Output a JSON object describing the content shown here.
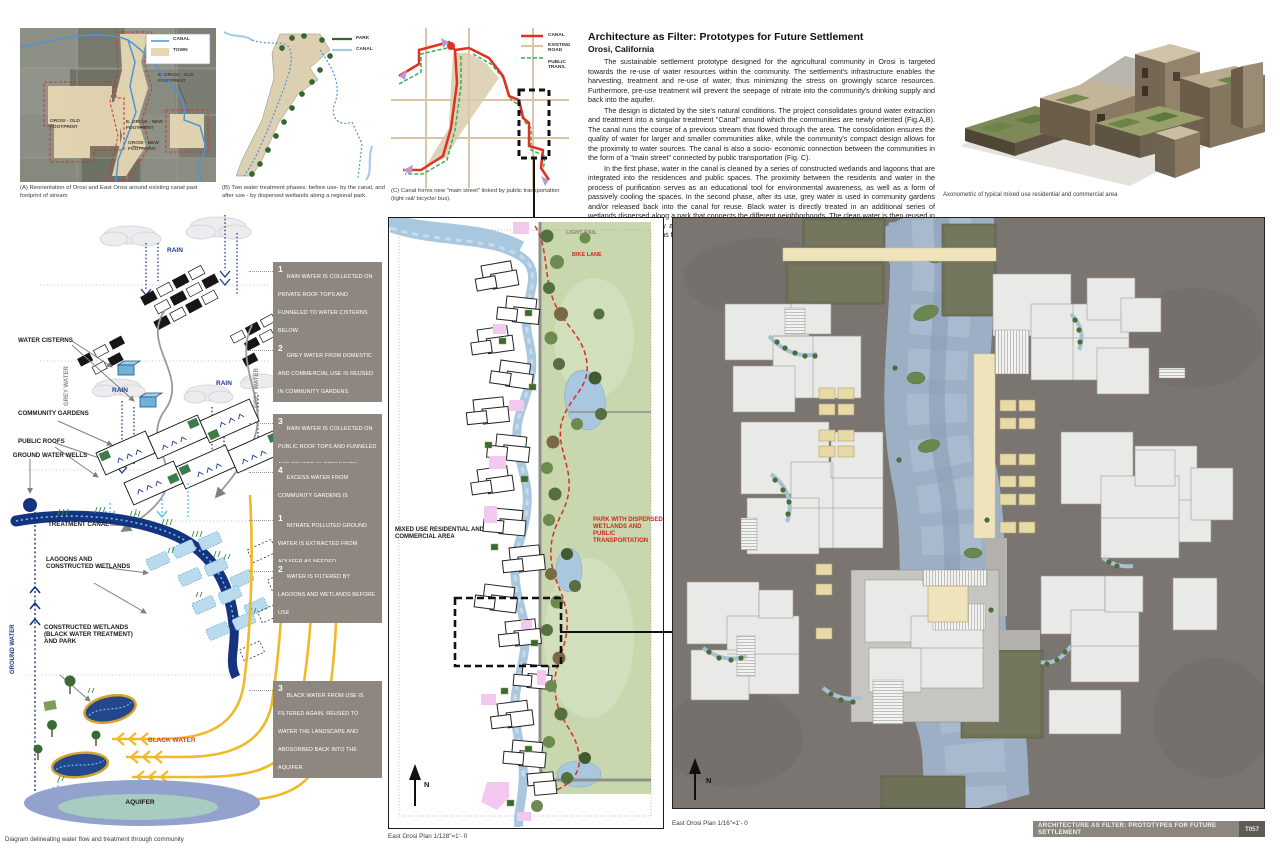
{
  "colors": {
    "canal_blue": "#4f93d8",
    "treatment_canal_navy": "#16337f",
    "park_green": "#c8d7ad",
    "black_water_yellow": "#f0b929",
    "note_box_gray": "#8d8780",
    "bike_lane_red": "#d93025",
    "town_tan": "#e6d7b2"
  },
  "header": {
    "title": "Architecture as Filter: Prototypes for Future Settlement",
    "subtitle": "Orosi, California",
    "p1": "The sustainable settlement prototype designed for the agricultural community in Orosi is targeted towards the re-use of water resources within the community. The settlement's infrastructure enables the harvesting, treatment and re-use of water, thus  minimizing the stress on growingly scarce resources. Furthermore, pre-use treatment will prevent the seepage of nitrate into the community's drinking supply and back into the aquifer.",
    "p2": "The design is dictated by the site's natural conditions. The project consolidates ground water extraction and treatment into a singular treatment \"Canal\" around which the communities are newly oriented (Fig.A,B). The canal runs the course of a previous stream that flowed through the area. The consolidation ensures the quality of water for larger and smaller communities alike, while the community's compact design allows for the proximity to water sources.  The canal is also a socio- economic connection between the communities in the form of a \"main street\" connected by public transportation (Fig. C).",
    "p3": "In the first phase, water in the canal is cleaned by a series of constructed wetlands and lagoons that are integrated into the residences and public spaces. The proximity between the residents and water in the process of purification serves as an educational tool for environmental awareness, as well as a form of passively cooling the spaces. In the second phase, after its use, grey water is used in community gardens and/or released back into the canal for reuse. Black water is directly treated in an additional series of wetlands dispersed along a park that connects the different neighborhoods.  The clean water is then reused in the park and eventually absorbed back into the aquifer. Finally, Cascading roof tops funnel rain water to gardens or water cisterns for future use."
  },
  "map_a": {
    "legend_canal": "CANAL",
    "legend_town": "TOWN",
    "label_eorosi_old": "E. OROSI - OLD FOOTPRINT",
    "label_orosi_old": "OROSI - OLD FOOTPRINT",
    "label_eorosi_new": "E. OROSI - NEW FOOTPRINT",
    "label_orosi_new": "OROSI - NEW FOOTPRINT",
    "caption": "(A) Reorientation of Orosi and East Orosi around existing canal past footprint of stream"
  },
  "map_b": {
    "legend_park": "PARK",
    "legend_canal": "CANAL",
    "caption": "(B) Two water treatment phases: before use- by the canal, and after use - by dispersed wetlands along a regional park."
  },
  "map_c": {
    "legend_canal": "CANAL",
    "legend_road": "EXISTING ROAD",
    "legend_trans": "PUBLIC TRANS.",
    "caption": "(C) Canal forms new \"main street\" linked by public transportation (light rail/ bicycle/ bus)."
  },
  "axon": {
    "caption": "Axonometric of typical mixed use residential and commercial area"
  },
  "water_diagram": {
    "labels": {
      "rain": "RAIN",
      "water_cisterns": "WATER CISTERNS",
      "grey_water": "GREY WATER",
      "community_gardens": "COMMUNITY GARDENS",
      "public_roofs": "PUBLIC ROOFS",
      "ground_water_wells": "GROUND WATER WELLS",
      "treatment_canal": "TREATMENT CANAL",
      "lagoons": "LAGOONS AND CONSTRUCTED WETLANDS",
      "ground_water": "GROUND WATER",
      "constructed_wetlands": "CONSTRUCTED WETLANDS (BLACK WATER TREATMENT) AND PARK",
      "black_water": "BLACK WATER",
      "aquifer": "AQUIFER"
    },
    "caption": "Diagram delineating water flow and treatment through community",
    "notes": [
      {
        "num": "1",
        "text": "RAIN WATER IS COLLECTED ON PRIVATE ROOF TOPS AND FUNNELED TO WATER CISTERNS BELOW."
      },
      {
        "num": "2",
        "text": "GREY WATER FROM DOMESTIC AND COMMERCIAL USE IS REUSED IN COMMUNITY GARDENS."
      },
      {
        "num": "3",
        "text": "RAIN WATER IS COLLECTED ON PUBLIC ROOF TOPS AND FUNNELED AND REUSED IN COMMUNITY GARDENS"
      },
      {
        "num": "4",
        "text": "EXCESS WATER FROM COMMUNITY GARDENS IS RELEASED BACK TO THE TREATMENT CANAL."
      },
      {
        "num": "1",
        "text": "NITRATE POLLUTED GROUND WATER IS EXTRACTED FROM AQUIFER AS NEEDED"
      },
      {
        "num": "2",
        "text": "WATER IS FILTERED BY LAGOONS AND WETLANDS BEFORE USE"
      },
      {
        "num": "3",
        "text": "BLACK WATER FROM USE IS FILTERED AGAIN, REUSED  TO WATER THE LANDSCAPE AND ABOSORBED BACK INTO THE AQUIFER"
      }
    ]
  },
  "site_plan": {
    "labels": {
      "light_rail": "LIGHT RAIL",
      "bike_lane": "BIKE LANE",
      "mixed_use": "MIXED USE RESIDENTIAL AND COMMERCIAL AREA",
      "park": "PARK WITH DISPERSED WETLANDS AND PUBLIC TRANSPORTATION",
      "north": "N"
    },
    "caption": "East Orosi Plan 1/128\"=1'- 0"
  },
  "detail_plan": {
    "labels": {
      "north": "N"
    },
    "caption": "East Orosi Plan 1/16\"=1'- 0"
  },
  "title_block": {
    "title": "ARCHITECTURE AS FILTER: PROTOTYPES FOR FUTURE SETTLEMENT",
    "sheet": "T057"
  }
}
